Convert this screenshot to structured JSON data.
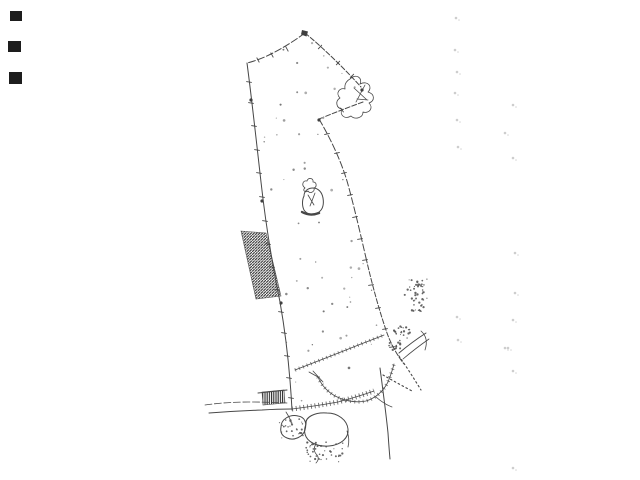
{
  "meta": {
    "description": "Scanned cadastral survey sketch of an elongated land parcel, black ink on white paper, no text labels"
  },
  "colors": {
    "background": "#ffffff",
    "ink": "#474747",
    "hatch": "#2f2f2f",
    "stipple": "#565656",
    "blob": "#3f3f3f",
    "faint": "#b8b8b8",
    "edge_mark": "#1d1d1d"
  },
  "drawing": {
    "paths": {
      "top_left_edge": "M305,33 Q272,57 247,63",
      "top_right_edge": "M305,33 C321,46 343,67 361,87",
      "apex_mark": "M302,30 l6,1.5 l-1.5,5 l-5.5,-2 Z",
      "ne_scribble": "M350,79 c6,-6 13,-1 10,5 c8,-4 13,3 8,8 c7,2 7,9 1,11 c5,5 0,11 -6,9 c0,6 -8,8 -12,4 c-6,4 -12,-1 -9,-7 c-6,-1 -7,-8 -2,-11 c-5,-5 0,-11 5,-9 c-1,-6 3,-9 5,-10 M354,88 l13,12 M365,85 l-9,17 M357,99 l11,1",
      "notch_upper_edge": "M363,102 Q341,110 319,119",
      "right_boundary_upper": "M319,119 C329,136 340,158 347,181 C353,202 360,232 366,258",
      "right_boundary_lower": "M366,258 C372,284 379,310 387,333 C391,344 397,355 404,364",
      "left_boundary": "M247,63 C252,101 256,138 261,182 C266,227 272,263 280,302 C286,336 290,372 292,410",
      "stream_line": "M380,368 C383,391 386,413 388,433 Q389,448 390,459",
      "junction_link": "M376,397 Q384,404 392,407",
      "road_top_line": "M205,405 Q226,402 248,402 Q268,402 287,403",
      "road_bottom_line": "M209,413 Q236,411 262,410 Q278,409 291,409",
      "hedge_roadside": "M292,409 Q316,406 338,402 Q357,397 374,391",
      "hedge_upper": "M295,370 Q331,356 361,344 Q374,339 384,335",
      "arc_lower": "M318,377 Q323,389 335,396 Q351,404 366,401 Q380,397 388,382 Q392,372 394,364",
      "arc_start_bar": "M313,371 L323,382 M318,377 L309,372",
      "ne_stub_a": "M399,353 Q412,342 426,333",
      "ne_stub_b": "M403,359 Q416,348 429,339",
      "hook_ne": "M421,331 Q429,338 425,350",
      "diag_dotted_a": "M399,356 Q410,372 421,390",
      "diag_dotted_b": "M383,375 Q397,383 412,391",
      "pond_left": "M281,427 C281,419 290,414 298,416 C305,417 307,423 305,430 C303,437 294,441 287,438 C282,436 280,432 281,427 Z",
      "pond_right": "M306,424 C305,417 315,412 327,413 C338,413 347,420 348,429 C349,438 341,445 329,446 C317,447 307,442 305,434 C304,430 305,427 306,424 Z",
      "pond_tail": "M347,431 Q350,439 348,447",
      "squiggle_below_pond": "M316,444 Q312,450 317,455 Q320,459 316,463",
      "pond_road_link": "M286,412 Q288,415 290,419",
      "hatch_stub_topline": "M258,393 L287,390",
      "building_outline": "M304,196 C304,191 308,188 313,188 C318,188 322,192 323,198 C324,204 323,209 319,212 C314,215 307,215 304,210 C302,206 302,200 304,196 Z",
      "building_bottom": "M302,212 Q310,216.5 319,213",
      "building_knot": "M305,188 c-4,-3 -2,-8 2,-7 c1,-4 7,-3 6,1 c4,0 4,5 1,6 c1,4 -4,6 -6,3 c-3,2 -6,-1 -3,-3",
      "building_inner": "M308,195 l6,10 M315,193 l-5,13"
    },
    "hatch_block_points": "241,231 266,233 281,296 256,299",
    "hatch_stub_points": "262,392 284,390 285,403 263,405",
    "ticks": [
      [
        258,
        60,
        62
      ],
      [
        272,
        55,
        62
      ],
      [
        287,
        49,
        62
      ],
      [
        320,
        47,
        -48
      ],
      [
        338,
        63,
        -48
      ],
      [
        352,
        76,
        -48
      ],
      [
        342,
        110,
        55
      ],
      [
        249,
        82,
        8
      ],
      [
        251,
        103,
        8
      ],
      [
        254,
        126,
        8
      ],
      [
        257,
        150,
        8
      ],
      [
        259,
        173,
        8
      ],
      [
        262,
        197,
        8
      ],
      [
        265,
        221,
        8
      ],
      [
        268,
        244,
        8
      ],
      [
        272,
        267,
        8
      ],
      [
        277,
        290,
        8
      ],
      [
        281,
        312,
        8
      ],
      [
        284,
        333,
        8
      ],
      [
        287,
        356,
        8
      ],
      [
        289,
        378,
        8
      ],
      [
        291,
        398,
        8
      ],
      [
        327,
        134,
        -12
      ],
      [
        337,
        153,
        -12
      ],
      [
        344,
        173,
        -12
      ],
      [
        350,
        195,
        -12
      ],
      [
        355,
        217,
        -12
      ],
      [
        360,
        239,
        -10
      ],
      [
        365,
        260,
        -10
      ],
      [
        371,
        285,
        -10
      ],
      [
        378,
        308,
        -10
      ],
      [
        385,
        329,
        -8
      ],
      [
        392,
        347,
        -8
      ]
    ],
    "blobs": [
      [
        251,
        100
      ],
      [
        262,
        201
      ],
      [
        281,
        303
      ],
      [
        319,
        120
      ],
      [
        362,
        90
      ]
    ],
    "stipple_patches": [
      {
        "x": 279,
        "y": 419,
        "w": 25,
        "h": 19,
        "n": 26,
        "seed": 7
      },
      {
        "x": 306,
        "y": 442,
        "w": 37,
        "h": 20,
        "n": 42,
        "seed": 11
      },
      {
        "x": 404,
        "y": 277,
        "w": 23,
        "h": 19,
        "n": 30,
        "seed": 3
      },
      {
        "x": 411,
        "y": 297,
        "w": 16,
        "h": 15,
        "n": 20,
        "seed": 5
      },
      {
        "x": 394,
        "y": 326,
        "w": 16,
        "h": 14,
        "n": 22,
        "seed": 9
      },
      {
        "x": 389,
        "y": 340,
        "w": 12,
        "h": 10,
        "n": 14,
        "seed": 13
      }
    ],
    "parcel_polygon": [
      [
        305,
        33
      ],
      [
        250,
        63
      ],
      [
        293,
        405
      ],
      [
        340,
        398
      ],
      [
        382,
        350
      ],
      [
        367,
        260
      ],
      [
        347,
        180
      ],
      [
        320,
        120
      ],
      [
        362,
        100
      ],
      [
        350,
        76
      ]
    ],
    "fleck_count": 58,
    "faint_specks": [
      [
        456,
        18
      ],
      [
        455,
        50
      ],
      [
        457,
        72
      ],
      [
        455,
        93
      ],
      [
        457,
        120
      ],
      [
        458,
        147
      ],
      [
        457,
        317
      ],
      [
        458,
        340
      ],
      [
        513,
        105
      ],
      [
        505,
        133
      ],
      [
        513,
        158
      ],
      [
        515,
        253
      ],
      [
        515,
        293
      ],
      [
        513,
        320
      ],
      [
        508,
        348
      ],
      [
        513,
        371
      ],
      [
        505,
        348
      ],
      [
        513,
        468
      ]
    ],
    "edge_marks": [
      {
        "x": 10,
        "y": 11,
        "w": 12,
        "h": 10
      },
      {
        "x": 8,
        "y": 41,
        "w": 13,
        "h": 11
      },
      {
        "x": 9,
        "y": 72,
        "w": 13,
        "h": 12
      }
    ]
  }
}
